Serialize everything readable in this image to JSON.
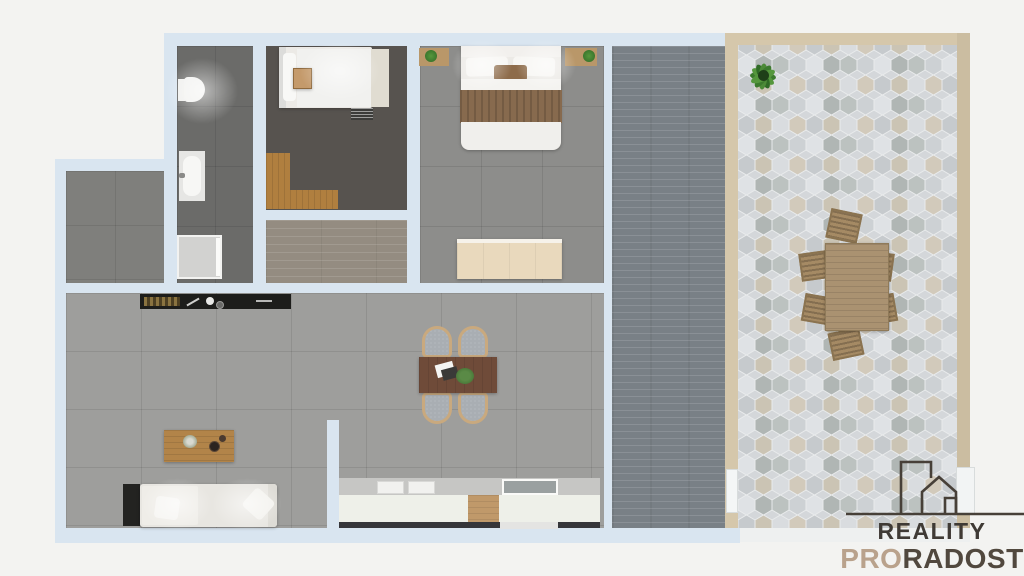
{
  "branding": {
    "line1": "REALITY",
    "line2_accent": "PRO",
    "line2_rest": "RADOST",
    "line1_color": "#3f3a35",
    "accent_color": "#b9a28c",
    "line2_rest_color": "#51483e",
    "icon": "house-buildings-outline-icon",
    "icon_color": "#474038"
  },
  "colors": {
    "background": "#f3f3f1",
    "wall": "#d9e5f0",
    "bathroom_floor": "#6b6b69",
    "bedroom_single_floor": "#57534f",
    "bedroom_double_floor": "#8d8d8b",
    "storage_room_floor": "#7f7f7c",
    "hallway_wood_floor": "#948c81",
    "living_room_floor": "#9e9e9c",
    "balcony_floor": "#798086",
    "terrace_frame": "#d5c7ab",
    "terrace_frame_right": "#cbbda1",
    "terrace_bottom_strip": "#eef0f0",
    "sofa": "#e8e6e1",
    "sofa_side_unit": "#232321",
    "coffee_table": "#b28449",
    "dining_table": "#6f4b39",
    "outdoor_table": "#aa9271",
    "outdoor_chair": "#a58a64",
    "bed_white": "#eceae6",
    "duvet_white": "#f1f1ef",
    "blanket_brown": "#876a4e",
    "pillow_brown": "#8d6b4a",
    "wardrobe": "#e9d9bd",
    "desk_wood": "#b07f3f",
    "tray_wood": "#c49a6b",
    "nightstand_wood": "#b99769",
    "kitchen_counter_dark": "#1d1d1b",
    "kitchen_cabinet": "#eef0e9",
    "kitchen_backsplash": "#c6c6c4",
    "kitchen_wood_cabinet": "#c0996a",
    "sink": "#9aa0a0",
    "plant_green": "#3c7a2e",
    "bathtub": "#e6e6e4",
    "shower": "#d2d2d0",
    "toilet": "#f2f2f0"
  }
}
